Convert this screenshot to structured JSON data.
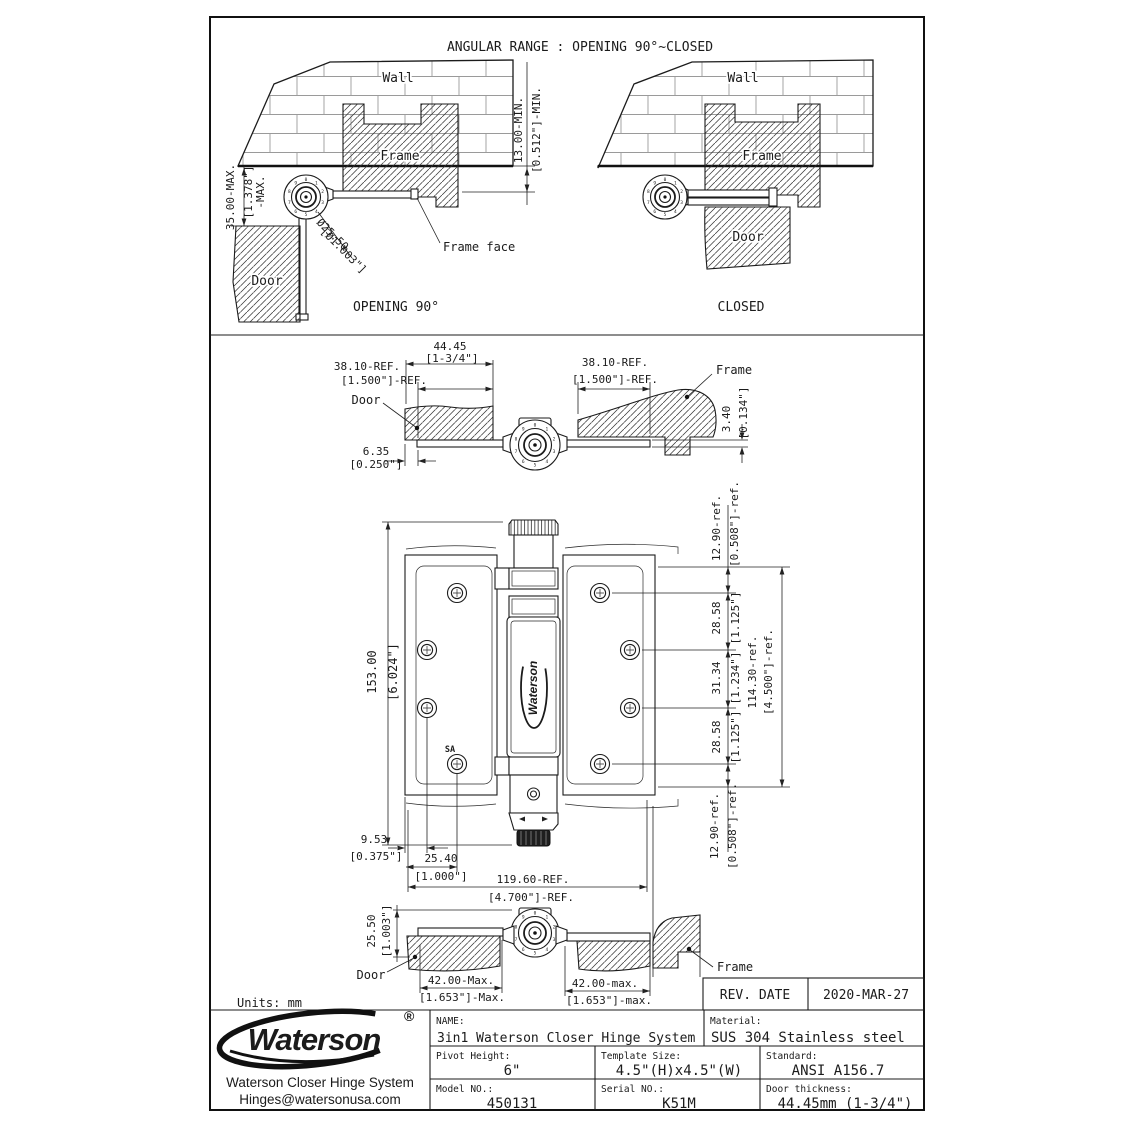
{
  "dial_digits": [
    "0",
    "1",
    "2",
    "3",
    "4",
    "5",
    "6",
    "7",
    "8",
    "9"
  ],
  "sheet": {
    "title": "ANGULAR RANGE : OPENING 90°~CLOSED",
    "units_note": "Units: mm"
  },
  "opening_view": {
    "wall": "Wall",
    "frame": "Frame",
    "door": "Door",
    "caption": "OPENING 90°",
    "frame_face": "Frame face",
    "dim_35_mm": "35.00-MAX.",
    "dim_35_in": "[1.378\"]",
    "dim_35_suffix": "-MAX.",
    "dim_13_mm": "13.00-MIN.",
    "dim_13_in": "[0.512\"]-MIN.",
    "dia_mm": "Ø25.50",
    "dia_in": "[Ø1.003\"]"
  },
  "closed_view": {
    "wall": "Wall",
    "frame": "Frame",
    "door": "Door",
    "caption": "CLOSED"
  },
  "section_view": {
    "dim_4445_mm": "44.45",
    "dim_4445_in": "[1-3/4\"]",
    "dim_3810_left_mm": "38.10-REF.",
    "dim_3810_left_in": "[1.500\"]-REF.",
    "dim_3810_right_mm": "38.10-REF.",
    "dim_3810_right_in": "[1.500\"]-REF.",
    "door": "Door",
    "frame": "Frame",
    "dim_635_mm": "6.35",
    "dim_635_in": "[0.250\"]",
    "dim_340_mm": "3.40",
    "dim_340_in": "[0.134\"]"
  },
  "front_view": {
    "dim_height_mm": "153.00",
    "dim_height_in": "[6.024\"]",
    "dim_top_ref_mm": "12.90-ref.",
    "dim_top_ref_in": "[0.508\"]-ref.",
    "dim_row1_mm": "28.58",
    "dim_row1_in": "[1.125\"]",
    "dim_row2_mm": "31.34",
    "dim_row2_in": "[1.234\"]",
    "dim_row3_mm": "28.58",
    "dim_row3_in": "[1.125\"]",
    "dim_leaf_mm": "114.30-ref.",
    "dim_leaf_in": "[4.500\"]-ref.",
    "dim_bot_ref_mm": "12.90-ref.",
    "dim_bot_ref_in": "[0.508\"]-ref.",
    "dim_953_mm": "9.53",
    "dim_953_in": "[0.375\"]",
    "dim_2540_mm": "25.40",
    "dim_2540_in": "[1.000\"]",
    "dim_width_mm": "119.60-REF.",
    "dim_width_in": "[4.700\"]-REF.",
    "sa_mark": "SA",
    "barrel_logo": "Waterson"
  },
  "bottom_view": {
    "dim_2550_mm": "25.50",
    "dim_2550_in": "[1.003\"]",
    "door": "Door",
    "frame": "Frame",
    "dim_42_left_mm": "42.00-Max.",
    "dim_42_left_in": "[1.653\"]-Max.",
    "dim_42_right_mm": "42.00-max.",
    "dim_42_right_in": "[1.653\"]-max."
  },
  "title_block": {
    "rev_date_label": "REV. DATE",
    "rev_date_value": "2020-MAR-27",
    "brand": "Waterson",
    "brand_reg": "®",
    "company": "Waterson Closer Hinge System",
    "email": "Hinges@watersonusa.com",
    "name_label": "NAME:",
    "name_value": "3in1 Waterson Closer Hinge System",
    "material_label": "Material:",
    "material_value": "SUS 304 Stainless steel",
    "pivot_label": "Pivot Height:",
    "pivot_value": "6\"",
    "template_label": "Template Size:",
    "template_value": "4.5\"(H)x4.5\"(W)",
    "standard_label": "Standard:",
    "standard_value": "ANSI A156.7",
    "model_label": "Model NO.:",
    "model_value": "450131",
    "serial_label": "Serial NO.:",
    "serial_value": "K51M",
    "thickness_label": "Door thickness:",
    "thickness_value": "44.45mm (1-3/4\")"
  }
}
